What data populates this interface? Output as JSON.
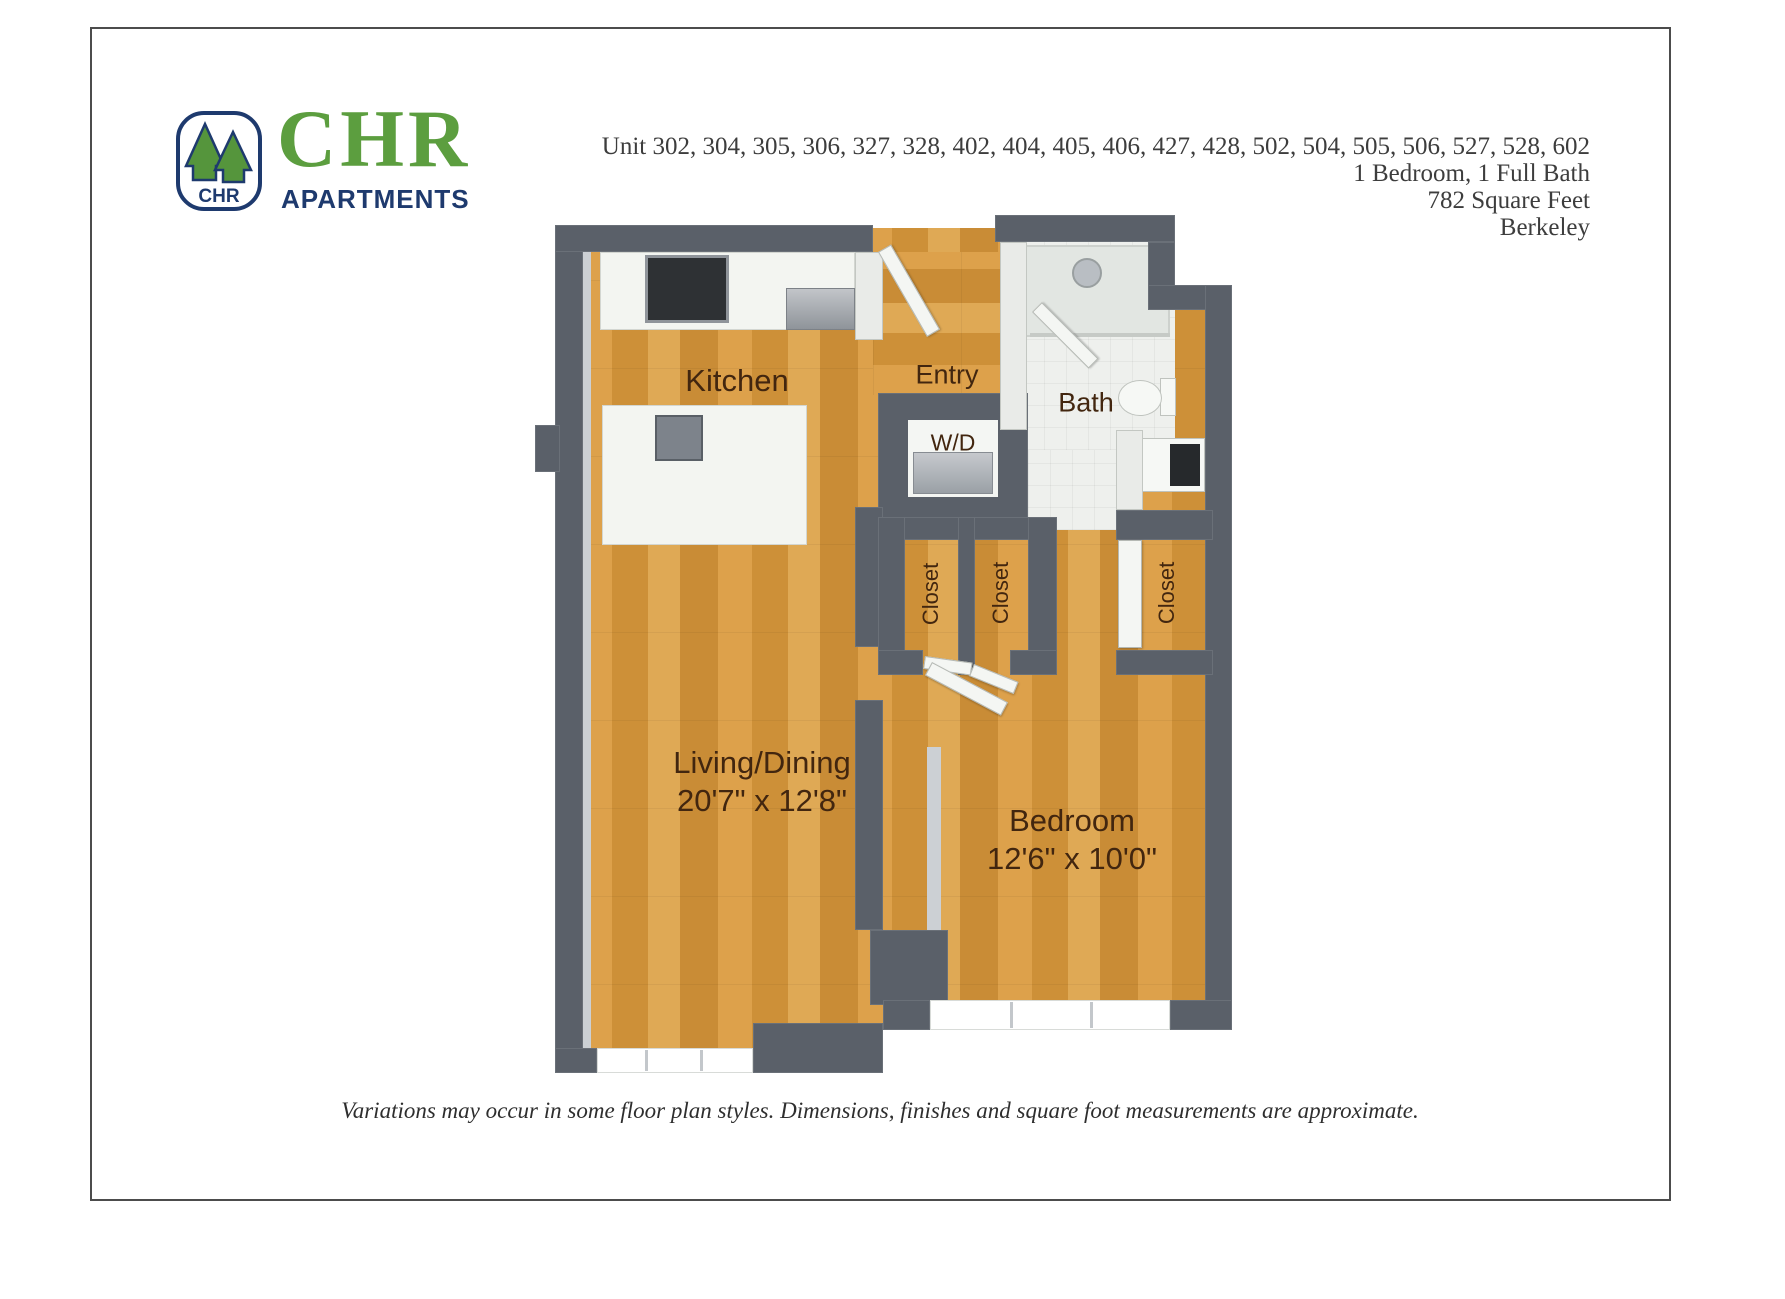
{
  "logo": {
    "icon_text": "CHR",
    "brand": "CHR",
    "subtitle": "APARTMENTS",
    "green": "#5c9e3f",
    "navy": "#1e3a6e"
  },
  "header": {
    "units_line": "Unit 302, 304, 305, 306, 327, 328, 402, 404, 405, 406, 427, 428, 502, 504, 505, 506, 527, 528, 602",
    "bed_bath": "1 Bedroom, 1 Full Bath",
    "square_feet": "782 Square Feet",
    "city": "Berkeley"
  },
  "floorplan": {
    "rooms": {
      "kitchen": {
        "label": "Kitchen"
      },
      "entry": {
        "label": "Entry"
      },
      "bath": {
        "label": "Bath"
      },
      "wd": {
        "label": "W/D"
      },
      "closet1": {
        "label": "Closet"
      },
      "closet2": {
        "label": "Closet"
      },
      "closet3": {
        "label": "Closet"
      },
      "living": {
        "label": "Living/Dining",
        "dimensions": "20'7\" x 12'8\""
      },
      "bedroom": {
        "label": "Bedroom",
        "dimensions": "12'6\" x 10'0\""
      }
    },
    "colors": {
      "wall": "#5a6069",
      "wood": "#d5993f",
      "label_text": "#42260f"
    }
  },
  "footer": {
    "disclaimer": "Variations may occur in some floor plan styles. Dimensions, finishes and square foot measurements are approximate."
  }
}
